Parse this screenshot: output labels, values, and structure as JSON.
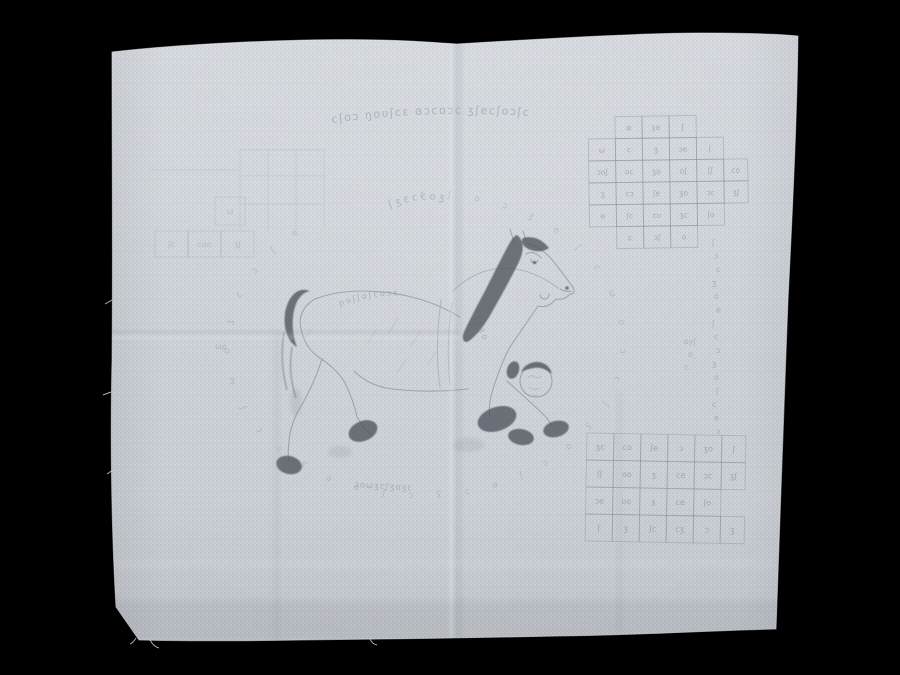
{
  "meta": {
    "subject": "photograph of a handwoven cotton yantra cloth with a galloping horse drawing, magic-square grids and script",
    "background_color": "#000000"
  },
  "cloth": {
    "base_color": "#cdd1d8",
    "weave_light": "#d4d8de",
    "weave_dark": "#c6cbd2",
    "edge_highlight": "#e9ebef",
    "ink_color": "#6d7380",
    "ink_dark": "#3e434b"
  },
  "inscriptions": {
    "top_line": "cʃoɔ ŋoʋʃcɛ ɞɔcoɔc ʒʃecʃoɔʃc",
    "upper_left_line": "ʃʒɛccoʒ",
    "back_chain": "ɲʋʃʃoʃcoɔc",
    "neck_chain": "ʃcʒo",
    "bottom_chain": "ɔoωʒcʃʒoʒc",
    "ring": "cʃoɔʒeʃcωoɔcʃʒocʃeɔʒcʃoeʒɔcʃωoʒcɔʃe",
    "right_column": "ʃɔcʒoeʃcɔʒoʃceɔ",
    "side_notes": [
      {
        "t": "ɷyʃ",
        "x": 683,
        "y": 344
      },
      {
        "t": "o˛",
        "x": 688,
        "y": 357
      },
      {
        "t": "c.",
        "x": 684,
        "y": 370
      },
      {
        "t": "ωρ",
        "x": 215,
        "y": 349
      }
    ]
  },
  "grids": {
    "top_right": {
      "x": 588,
      "y": 117,
      "cw": 27,
      "ch": 22,
      "ext_col": 5,
      "ext_w": 24,
      "tilt": -0.8,
      "line_opacity": 0.4,
      "text_opacity": 0.5,
      "font": 7.5,
      "cells": [
        [
          1,
          0,
          "ɷ"
        ],
        [
          2,
          0,
          "ʒɞ"
        ],
        [
          3,
          0,
          "ʃ"
        ],
        [
          0,
          1,
          "ω"
        ],
        [
          1,
          1,
          "c"
        ],
        [
          2,
          1,
          "ʒ"
        ],
        [
          3,
          1,
          "ɔe"
        ],
        [
          4,
          1,
          "ʃ"
        ],
        [
          0,
          2,
          "ɔoʃ"
        ],
        [
          1,
          2,
          "ʋc"
        ],
        [
          2,
          2,
          "ʒo"
        ],
        [
          3,
          2,
          "oʃ"
        ],
        [
          4,
          2,
          "ʃʃ"
        ],
        [
          5,
          2,
          "co"
        ],
        [
          0,
          3,
          "ʒ"
        ],
        [
          1,
          3,
          "cɔ"
        ],
        [
          2,
          3,
          "ʃe"
        ],
        [
          3,
          3,
          "ʒo"
        ],
        [
          4,
          3,
          "ɔc"
        ],
        [
          5,
          3,
          "ʒʃ"
        ],
        [
          0,
          4,
          "e"
        ],
        [
          1,
          4,
          "ʃc"
        ],
        [
          2,
          4,
          "cʋ"
        ],
        [
          3,
          4,
          "ʒc"
        ],
        [
          4,
          4,
          "ʃo"
        ],
        [
          1,
          5,
          "c"
        ],
        [
          2,
          5,
          "ɔʃ"
        ],
        [
          3,
          5,
          "o"
        ]
      ]
    },
    "bottom_right": {
      "x": 587,
      "y": 433,
      "cw": 27,
      "ch": 27,
      "ext_col": 5,
      "ext_w": 24,
      "tilt": 1.0,
      "line_opacity": 0.38,
      "text_opacity": 0.5,
      "font": 8,
      "cells": [
        [
          0,
          0,
          "ʒc"
        ],
        [
          1,
          0,
          "co"
        ],
        [
          2,
          0,
          "ʃe"
        ],
        [
          3,
          0,
          "ɔ"
        ],
        [
          4,
          0,
          "ʒo"
        ],
        [
          5,
          0,
          "ʃ"
        ],
        [
          0,
          1,
          "ʃʃ"
        ],
        [
          1,
          1,
          "oo"
        ],
        [
          2,
          1,
          "ʒ"
        ],
        [
          3,
          1,
          "ce"
        ],
        [
          4,
          1,
          "ɔc"
        ],
        [
          5,
          1,
          "ʒʃ"
        ],
        [
          0,
          2,
          "ɔe"
        ],
        [
          1,
          2,
          "ʋo"
        ],
        [
          2,
          2,
          "ʒ"
        ],
        [
          3,
          2,
          "ce"
        ],
        [
          4,
          2,
          "ʃo"
        ],
        [
          0,
          3,
          "ʃ"
        ],
        [
          1,
          3,
          "ʒ"
        ],
        [
          2,
          3,
          "ʃc"
        ],
        [
          3,
          3,
          "cʒ"
        ],
        [
          4,
          3,
          "ɔ"
        ],
        [
          5,
          3,
          "ʒ"
        ]
      ]
    },
    "left_row": {
      "x": 155,
      "y": 231,
      "cw": 33,
      "ch": 26,
      "tilt": 0,
      "line_opacity": 0.2,
      "text_opacity": 0.3,
      "font": 8,
      "cells": [
        [
          0,
          0,
          "ʃc"
        ],
        [
          1,
          0,
          "coo"
        ],
        [
          2,
          0,
          "ʒʃ"
        ]
      ]
    },
    "left_single": {
      "x": 215,
      "y": 197,
      "cw": 30,
      "ch": 28,
      "tilt": 0,
      "line_opacity": 0.2,
      "text_opacity": 0.3,
      "font": 8,
      "cells": [
        [
          0,
          0,
          "ω"
        ]
      ]
    }
  },
  "right_column_geom": {
    "x": 714,
    "y0": 245,
    "step": 13.5,
    "font": 8,
    "opacity": 0.42
  }
}
